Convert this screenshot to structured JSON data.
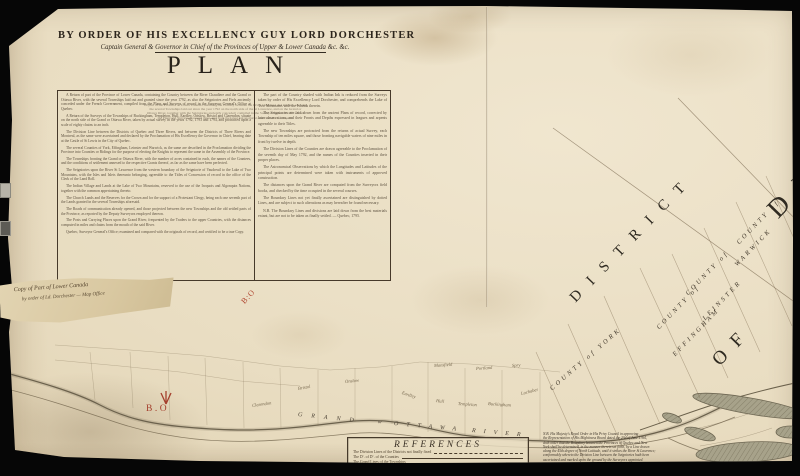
{
  "header": {
    "order_line": "BY ORDER OF HIS EXCELLENCY GUY LORD DORCHESTER",
    "gov_prefix": "Captain General & ",
    "gov_mid": "Governor in Chief of the Provinces of Upper & Lower Canada",
    "gov_suffix": " &c. &c.",
    "title": "PLAN",
    "subtitle_lines": [
      "Of part of the Province of Lower Canada containing the Country between the River Chaudiere and Quebec, shewing",
      "the several Townships laid out since the year 1792 on the north side of the St Lawrence, and on the Grand or",
      "Ottawa River, together with the Seigniories anciently conceded; compiled in the Surveyor General's Office from",
      "the Plans and Surveys of record there, and from the latest astronomical observations. — reduced."
    ]
  },
  "cartouche": {
    "left_paragraphs": [
      "A Return of part of the Province of Lower Canada, containing the Country between the River Chaudiere and the Grand or Ottawa River, with the several Townships laid out and granted since the year 1792, as also the Seigniories and Fiefs anciently conceded under the French Government, compiled from the Plans and Surveys of record in the Surveyor General's Office at Quebec.",
      "A Return of the Surveys of the Townships of Buckingham, Templeton, Hull, Eardley, Onslow, Bristol and Clarendon, situate on the north side of the Grand or Ottawa River, taken by actual survey in the years 1792, 1793 and 1794, and protracted upon a scale of eighty chains to an inch.",
      "The Division Line between the Districts of Quebec and Three Rivers, and between the Districts of Three Rivers and Montreal, as the same were ascertained and declared by the Proclamation of His Excellency the Governor in Chief, bearing date at the Castle of St Lewis in the City of Quebec.",
      "The several Counties of York, Effingham, Leinster and Warwick, as the same are described in the Proclamation dividing the Province into Counties or Ridings for the purpose of electing the Knights to represent the same in the Assembly of the Province.",
      "The Townships fronting the Grand or Ottawa River, with the number of acres contained in each, the names of the Grantees, and the conditions of settlement annexed to the respective Grants thereof, as far as the same have been perfected.",
      "The Seigniories upon the River St Lawrence from the western boundary of the Seigniorie of Vaudreuil to the Lake of Two Mountains, with the Isles and Islets thereunto belonging, agreeable to the Titles of Concession of record in the office of the Clerk of the Land Roll.",
      "The Indian Village and Lands at the Lake of Two Mountains, reserved to the use of the Iroquois and Algonquin Nations, together with the common appertaining thereto.",
      "The Church Lands and the Reserves for the Crown and for the support of a Protestant Clergy, being each one seventh part of the Lands granted in the several Townships aforesaid.",
      "The Roads of communication already opened, and those projected between the new Townships and the old settled parts of the Province, as reported by the Deputy Surveyors employed thereon.",
      "The Posts and Carrying Places upon the Grand River, frequented by the Traders to the upper Countries, with the distances computed in miles and chains from the mouth of the said River.",
      "Quebec, Surveyor General's Office; examined and compared with the originals of record, and certified to be a true Copy."
    ],
    "right_paragraphs": [
      "The part of the Country shaded with Indian Ink is reduced from the Surveys taken by order of His Excellency Lord Dorchester, and comprehends the Lake of Two Mountains with the Islands therein.",
      "The Seigniories are laid down from the ancient Plans of record, corrected by later observations, and their Fronts and Depths expressed in leagues and arpents agreeable to their Titles.",
      "The new Townships are protracted from the returns of actual Survey, each Township of ten miles square, and those fronting navigable waters of nine miles in front by twelve in depth.",
      "The Division Lines of the Counties are drawn agreeable to the Proclamation of the seventh day of May 1792, and the names of the Counties inserted in their proper places.",
      "The Astronomical Observations by which the Longitudes and Latitudes of the principal points are determined were taken with instruments of approved construction.",
      "The distances upon the Grand River are computed from the Surveyors field books, and checked by the time occupied in the several courses.",
      "The Boundary Lines not yet finally ascertained are distinguished by dotted Lines, and are subject to such alterations as may hereafter be found necessary.",
      "N.B. The Boundary Lines and divisions are laid down from the best materials extant, but are not to be taken as finally settled. — Quebec, 1795."
    ]
  },
  "references": {
    "title": "REFERENCES",
    "rows": [
      "The Division Lines of the Districts not finally fixed",
      "The  Dº.  of  Dº.  of the Counties",
      "The Grand Lines of the Townships"
    ]
  },
  "nb_note": {
    "lines": [
      "N.B. His Majesty's Royal Order in His Privy Council in approving",
      "the Representation of His Mightiness Board dated the 23d of June 1764,",
      "doth order that the Boundary between the Provinces of Quebec and New",
      "York shall be determined, in the manner therein set forth, by a Line drawn",
      "along the 45th degree of North Latitude, until it strikes the River St Lawrence;",
      "conformably whereto the Division Line between the Seigniories hath been",
      "ascertained and marked upon the ground by the Surveyors appointed."
    ]
  },
  "handwriting": {
    "line1": "Copy of Part of Lower Canada",
    "line2": "by order of Ld. Dorchester — Map Office"
  },
  "stamps": {
    "bo": "B.O",
    "diag": "B:O"
  },
  "map": {
    "labels": [
      {
        "t": "DISTRICT",
        "c": "big",
        "x": 573,
        "y": 292,
        "r": -46,
        "fs": 15,
        "ls": 13,
        "n": "district-label"
      },
      {
        "t": "DI",
        "c": "big",
        "x": 772,
        "y": 198,
        "r": -46,
        "fs": 27,
        "ls": 16,
        "n": "district-label-partial"
      },
      {
        "t": "OF",
        "c": "big",
        "x": 716,
        "y": 352,
        "r": -46,
        "fs": 19,
        "ls": 12,
        "n": "district-of-label"
      },
      {
        "t": "COUNTY of YORK",
        "c": "county",
        "x": 551,
        "y": 386,
        "r": -41,
        "n": "county-york-label"
      },
      {
        "t": "COUNTY of",
        "c": "county",
        "x": 658,
        "y": 325,
        "r": -46,
        "n": "county-effingham-label"
      },
      {
        "t": "EFFINGHAM",
        "c": "county",
        "x": 674,
        "y": 352,
        "r": -46,
        "n": "county-effingham-label"
      },
      {
        "t": "COUNTY of",
        "c": "county",
        "x": 687,
        "y": 291,
        "r": -46,
        "n": "county-leinster-label"
      },
      {
        "t": "LEINSTER",
        "c": "county",
        "x": 704,
        "y": 316,
        "r": -46,
        "n": "county-leinster-label"
      },
      {
        "t": "COUNTY of",
        "c": "county",
        "x": 738,
        "y": 240,
        "r": -46,
        "n": "county-warwick-label"
      },
      {
        "t": "WARWICK",
        "c": "county",
        "x": 736,
        "y": 262,
        "r": -46,
        "n": "county-warwick-label"
      },
      {
        "t": "Clarendon",
        "c": "town",
        "x": 252,
        "y": 403,
        "r": -8,
        "n": "township-label"
      },
      {
        "t": "Bristol",
        "c": "town",
        "x": 298,
        "y": 386,
        "r": -10,
        "n": "township-label"
      },
      {
        "t": "Onslow",
        "c": "town",
        "x": 345,
        "y": 379,
        "r": -6,
        "n": "township-label"
      },
      {
        "t": "Eardley",
        "c": "town",
        "x": 402,
        "y": 390,
        "r": 18,
        "n": "township-label"
      },
      {
        "t": "Hull",
        "c": "town",
        "x": 436,
        "y": 398,
        "r": 6,
        "n": "township-label"
      },
      {
        "t": "Templeton",
        "c": "town",
        "x": 458,
        "y": 401,
        "r": 4,
        "n": "township-label"
      },
      {
        "t": "Buckingham",
        "c": "town",
        "x": 488,
        "y": 401,
        "r": 4,
        "n": "township-label"
      },
      {
        "t": "Lochaber",
        "c": "town",
        "x": 521,
        "y": 391,
        "r": -14,
        "n": "township-label"
      },
      {
        "t": "Mansfield",
        "c": "town",
        "x": 434,
        "y": 363,
        "r": -4,
        "n": "township-label"
      },
      {
        "t": "Portland",
        "c": "town",
        "x": 476,
        "y": 366,
        "r": -4,
        "n": "township-label"
      },
      {
        "t": "Spry",
        "c": "town",
        "x": 512,
        "y": 363,
        "r": -4,
        "n": "township-label"
      },
      {
        "t": "GRAND",
        "c": "river",
        "x": 298,
        "y": 412,
        "r": 6,
        "ls": 9,
        "n": "river-label"
      },
      {
        "t": "or",
        "c": "river-sm",
        "x": 378,
        "y": 419,
        "r": 6,
        "n": "river-label"
      },
      {
        "t": "OTTAWA",
        "c": "river",
        "x": 394,
        "y": 421,
        "r": 5,
        "ls": 8,
        "n": "river-label"
      },
      {
        "t": "RIVER",
        "c": "river",
        "x": 472,
        "y": 428,
        "r": 5,
        "ls": 8,
        "n": "river-label"
      }
    ]
  }
}
